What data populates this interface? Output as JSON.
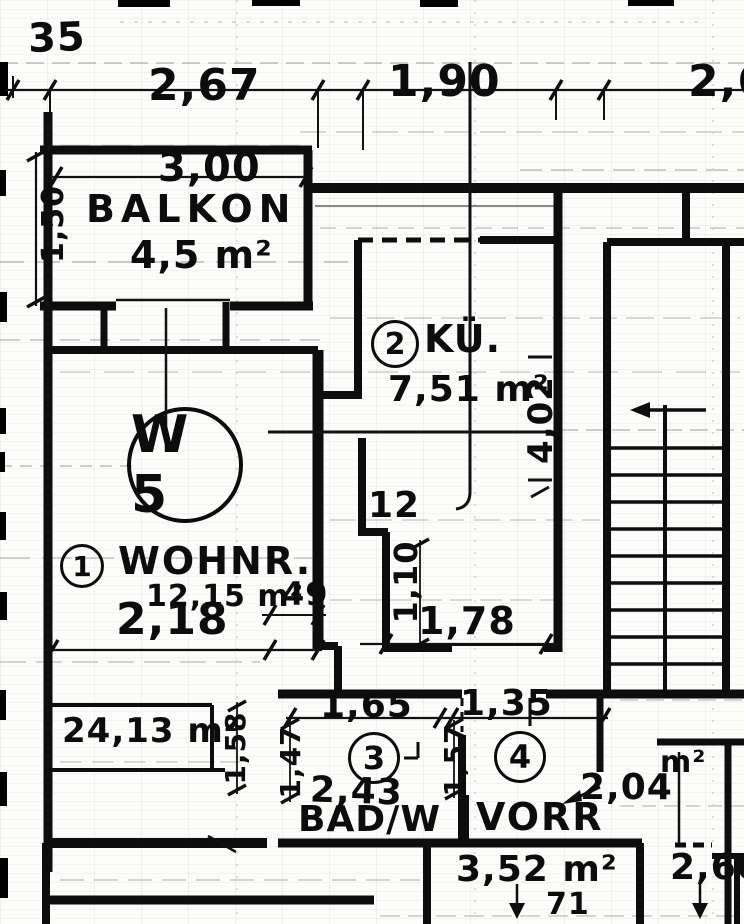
{
  "unit": {
    "label": "W 5"
  },
  "rooms": {
    "balkon": {
      "name": "BALKON",
      "area": "4,5 m²"
    },
    "wohnzimmer": {
      "index": "1",
      "name": "WOHNR.",
      "area": "12,15 m²",
      "area_total": "24,13 m²"
    },
    "kueche": {
      "index": "2",
      "name": "KÜ.",
      "area": "7,51 m²"
    },
    "bad": {
      "index": "3",
      "name": "BAD/W"
    },
    "vorraum": {
      "index": "4",
      "name": "VORR",
      "area_value": "2,04",
      "area_unit": "m²"
    },
    "nebenraum": {
      "area": "3,52 m²"
    }
  },
  "dims": {
    "d35": "35",
    "d267": "2,67",
    "d190": "1,90",
    "d260_top": "2,60",
    "d300": "3,00",
    "d150": "1,50",
    "d402": "4,02",
    "d12": "12",
    "d110": "1,10",
    "d178": "1,78",
    "d218": "2,18",
    "d49": "49",
    "d158": "1,58",
    "d147": "1,47",
    "d165": "1,65",
    "d135": "1,35",
    "d157": "1,57",
    "d243": "2,43",
    "d260_bottom": "2,60",
    "d71": "71"
  }
}
